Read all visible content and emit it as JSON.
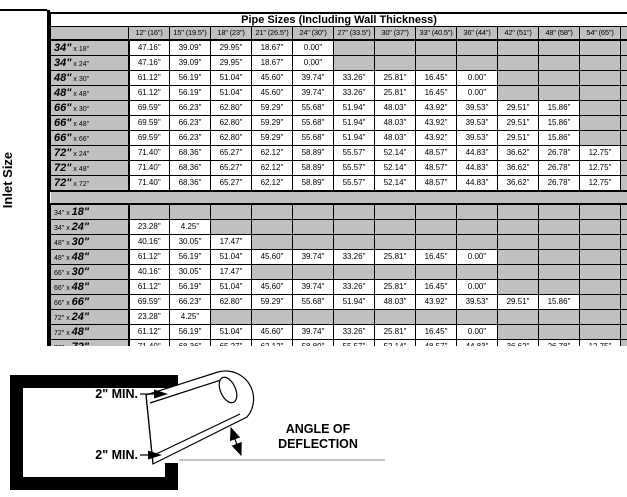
{
  "colors": {
    "cell_gray": "#c0c0c0",
    "border": "#000000",
    "background": "#ffffff"
  },
  "table": {
    "title": "Pipe Sizes (Including Wall Thickness)",
    "side_label": "Inlet Size",
    "columns": [
      "12\" (16\")",
      "15\" (19.5\")",
      "18\" (23\")",
      "21\" (26.5\")",
      "24\" (30\")",
      "27\" (33.5\")",
      "30\" (37\")",
      "33\" (40.5\")",
      "36\" (44\")",
      "42\" (51\")",
      "48\" (58\")",
      "54\" (65\")",
      "60\" ("
    ],
    "sections": [
      {
        "bold": "first",
        "rows": [
          {
            "d1": "34\"",
            "d2": "18\"",
            "values": [
              "47.16\"",
              "39.09\"",
              "29.95\"",
              "18.67\"",
              "0.00\"",
              "",
              "",
              "",
              "",
              "",
              "",
              "",
              ""
            ]
          },
          {
            "d1": "34\"",
            "d2": "24\"",
            "values": [
              "47.16\"",
              "39.09\"",
              "29.95\"",
              "18.67\"",
              "0.00\"",
              "",
              "",
              "",
              "",
              "",
              "",
              "",
              ""
            ]
          },
          {
            "d1": "48\"",
            "d2": "30\"",
            "values": [
              "61.12\"",
              "56.19\"",
              "51.04\"",
              "45.60\"",
              "39.74\"",
              "33.26\"",
              "25.81\"",
              "16.45\"",
              "0.00\"",
              "",
              "",
              "",
              ""
            ]
          },
          {
            "d1": "48\"",
            "d2": "48\"",
            "values": [
              "61.12\"",
              "56.19\"",
              "51.04\"",
              "45.60\"",
              "39.74\"",
              "33.26\"",
              "25.81\"",
              "16.45\"",
              "0.00\"",
              "",
              "",
              "",
              ""
            ]
          },
          {
            "d1": "66\"",
            "d2": "30\"",
            "values": [
              "69.59\"",
              "66.23\"",
              "62.80\"",
              "59.29\"",
              "55.68\"",
              "51.94\"",
              "48.03\"",
              "43.92\"",
              "39.53\"",
              "29.51\"",
              "15.86\"",
              "",
              ""
            ]
          },
          {
            "d1": "66\"",
            "d2": "48\"",
            "values": [
              "69.59\"",
              "66.23\"",
              "62.80\"",
              "59.29\"",
              "55.68\"",
              "51.94\"",
              "48.03\"",
              "43.92\"",
              "39.53\"",
              "29.51\"",
              "15.86\"",
              "",
              ""
            ]
          },
          {
            "d1": "66\"",
            "d2": "66\"",
            "values": [
              "69.59\"",
              "66.23\"",
              "62.80\"",
              "59.29\"",
              "55.68\"",
              "51.94\"",
              "48.03\"",
              "43.92\"",
              "39.53\"",
              "29.51\"",
              "15.86\"",
              "",
              ""
            ]
          },
          {
            "d1": "72\"",
            "d2": "24\"",
            "values": [
              "71.40\"",
              "68.36\"",
              "65.27\"",
              "62.12\"",
              "58.89\"",
              "55.57\"",
              "52.14\"",
              "48.57\"",
              "44.83\"",
              "36.62\"",
              "26.78\"",
              "12.75\"",
              ""
            ]
          },
          {
            "d1": "72\"",
            "d2": "48\"",
            "values": [
              "71.40\"",
              "68.36\"",
              "65.27\"",
              "62.12\"",
              "58.89\"",
              "55.57\"",
              "52.14\"",
              "48.57\"",
              "44.83\"",
              "36.62\"",
              "26.78\"",
              "12.75\"",
              ""
            ]
          },
          {
            "d1": "72\"",
            "d2": "72\"",
            "values": [
              "71.40\"",
              "68.36\"",
              "65.27\"",
              "62.12\"",
              "58.89\"",
              "55.57\"",
              "52.14\"",
              "48.57\"",
              "44.83\"",
              "36.62\"",
              "26.78\"",
              "12.75\"",
              ""
            ]
          }
        ]
      },
      {
        "bold": "second",
        "rows": [
          {
            "d1": "34\"",
            "d2": "18\"",
            "values": [
              "",
              "",
              "",
              "",
              "",
              "",
              "",
              "",
              "",
              "",
              "",
              "",
              ""
            ]
          },
          {
            "d1": "34\"",
            "d2": "24\"",
            "values": [
              "23.28\"",
              "4.25\"",
              "",
              "",
              "",
              "",
              "",
              "",
              "",
              "",
              "",
              "",
              ""
            ]
          },
          {
            "d1": "48\"",
            "d2": "30\"",
            "values": [
              "40.16\"",
              "30.05\"",
              "17.47\"",
              "",
              "",
              "",
              "",
              "",
              "",
              "",
              "",
              "",
              ""
            ]
          },
          {
            "d1": "48\"",
            "d2": "48\"",
            "values": [
              "61.12\"",
              "56.19\"",
              "51.04\"",
              "45.60\"",
              "39.74\"",
              "33.26\"",
              "25.81\"",
              "16.45\"",
              "0.00\"",
              "",
              "",
              "",
              ""
            ]
          },
          {
            "d1": "66\"",
            "d2": "30\"",
            "values": [
              "40.16\"",
              "30.05\"",
              "17.47\"",
              "",
              "",
              "",
              "",
              "",
              "",
              "",
              "",
              "",
              ""
            ]
          },
          {
            "d1": "66\"",
            "d2": "48\"",
            "values": [
              "61.12\"",
              "56.19\"",
              "51.04\"",
              "45.60\"",
              "39.74\"",
              "33.26\"",
              "25.81\"",
              "16.45\"",
              "0.00\"",
              "",
              "",
              "",
              ""
            ]
          },
          {
            "d1": "66\"",
            "d2": "66\"",
            "values": [
              "69.59\"",
              "66.23\"",
              "62.80\"",
              "59.29\"",
              "55.68\"",
              "51.94\"",
              "48.03\"",
              "43.92\"",
              "39.53\"",
              "29.51\"",
              "15.86\"",
              "",
              ""
            ]
          },
          {
            "d1": "72\"",
            "d2": "24\"",
            "values": [
              "23.28\"",
              "4.25\"",
              "",
              "",
              "",
              "",
              "",
              "",
              "",
              "",
              "",
              "",
              ""
            ]
          },
          {
            "d1": "72\"",
            "d2": "48\"",
            "values": [
              "61.12\"",
              "56.19\"",
              "51.04\"",
              "45.60\"",
              "39.74\"",
              "33.26\"",
              "25.81\"",
              "16.45\"",
              "0.00\"",
              "",
              "",
              "",
              ""
            ]
          },
          {
            "d1": "72\"",
            "d2": "72\"",
            "values": [
              "71.40\"",
              "68.36\"",
              "65.27\"",
              "62.12\"",
              "58.89\"",
              "55.57\"",
              "52.14\"",
              "48.57\"",
              "44.83\"",
              "36.62\"",
              "26.78\"",
              "12.75\"",
              ""
            ]
          }
        ]
      }
    ]
  },
  "diagram": {
    "top_clearance_label": "2\" MIN.",
    "bottom_clearance_label": "2\" MIN.",
    "angle_label_line1": "ANGLE OF",
    "angle_label_line2": "DEFLECTION"
  }
}
